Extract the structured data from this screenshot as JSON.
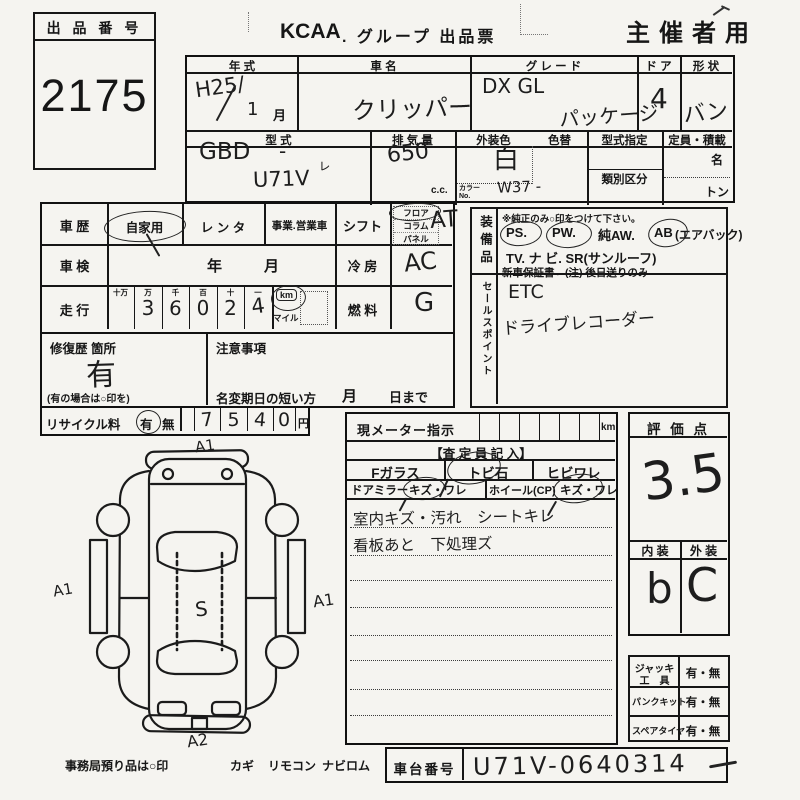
{
  "header": {
    "logo": "KCAA",
    "title": ". グループ 出品票",
    "organizer": "主催者用"
  },
  "lot": {
    "label": "出 品 番 号",
    "number": "2175"
  },
  "table1": {
    "year_h": "年  式",
    "name_h": "車  名",
    "grade_h": "グ レ ー ド",
    "door_h": "ド ア",
    "shape_h": "形 状",
    "year_v": "H25/",
    "year_month": "1",
    "month": "月",
    "name_v": "クリッパー",
    "grade_v1": "DX GL",
    "grade_v2": "パッケージ",
    "door_v": "4",
    "shape_v": "バン",
    "model_h": "型  式",
    "disp_h": "排 気 量",
    "color_h": "外装色",
    "recolor_h": "色替",
    "desig_h": "型式指定",
    "class_h": "類別区分",
    "cap_h": "定員・積載",
    "model_v1": "GBD",
    "model_dash": "-",
    "model_check": "ㇾ",
    "model_v2": "U71V",
    "disp_v": "650",
    "disp_u": "c.c.",
    "color_v": "白",
    "colorno_l1": "カラー",
    "colorno_l2": "No.",
    "colorno_v": "W37 -",
    "cap_u1": "名",
    "cap_u2": "トン"
  },
  "left": {
    "history_h": "車 歴",
    "private": "自家用",
    "rental": "レ ン タ",
    "business": "事業.営業車",
    "shaken_h": "車 検",
    "year": "年",
    "month": "月",
    "mileage_h": "走 行",
    "d_h": [
      "十万",
      "万",
      "千",
      "百",
      "十",
      "一"
    ],
    "d_v": [
      "",
      "3",
      "6",
      "0",
      "2",
      "4"
    ],
    "km": "km",
    "mile": "マイル",
    "shift_h": "シフト",
    "shift_opts": [
      "フロア",
      "コラム",
      "パネル"
    ],
    "shift_v": "AT",
    "ac_h": "冷 房",
    "ac_v": "AC",
    "fuel_h": "燃 料",
    "fuel_v": "G",
    "repair_h": "修復歴 箇所",
    "repair_v": "有",
    "repair_note": "(有の場合は○印を)",
    "caution_h": "注意事項",
    "rename_h": "名変期日の短い方",
    "rename_m": "月",
    "rename_d": "日まで",
    "recycle_h": "リサイクル料",
    "yes": "有",
    "no": "無",
    "fee": [
      "7",
      "5",
      "4",
      "0"
    ],
    "yen": "円"
  },
  "equip": {
    "label": "装備品",
    "note": "※純正のみ○印をつけて下さい。",
    "ps": "PS.",
    "pw": "PW.",
    "aw": "純AW.",
    "ab": "AB",
    "ab_s": "(エアバック)",
    "line2": "TV.  ナ ビ.  SR(サンルーフ)",
    "warranty": "新車保証書←(注) 後日送りのみ"
  },
  "sales": {
    "label": "セールスポイント",
    "v1": "ETC",
    "v2": "ドライブレコーダー"
  },
  "inspect": {
    "meter": "現メーター指示",
    "km": "km",
    "title": "【査 定 員 記 入】",
    "fglass": "Fガラス",
    "stone": "トビ石",
    "crack": "ヒビワレ",
    "mirror": "ドアミラー",
    "mirror_o": "キズ・ワレ",
    "wheel": "ホイール(CP)",
    "wheel_o": "キズ・ワレ",
    "note1": "室内キズ・汚れ　シートキレ",
    "note2": "看板あと　下処理ズ"
  },
  "score": {
    "h": "評 価 点",
    "v": "3.5",
    "int_h": "内 装",
    "ext_h": "外 装",
    "int_v": "b",
    "ext_v": "C"
  },
  "tools": {
    "jack1": "ジャッキ",
    "jack2": "工　具",
    "v1": "有・無",
    "punc": "パンクキット",
    "v2": "有・無",
    "spare": "スペアタイヤ",
    "v3": "有・無"
  },
  "chassis": {
    "h": "車台番号",
    "v": "U71V-0640314"
  },
  "footer": {
    "deposit": "事務局預り品は○印",
    "k1": "カギ",
    "k2": "リモコン",
    "k3": "ナビロム"
  },
  "marks": {
    "front": "A1",
    "left": "A1",
    "right": "A1",
    "roof": "S",
    "rear": "A2"
  }
}
